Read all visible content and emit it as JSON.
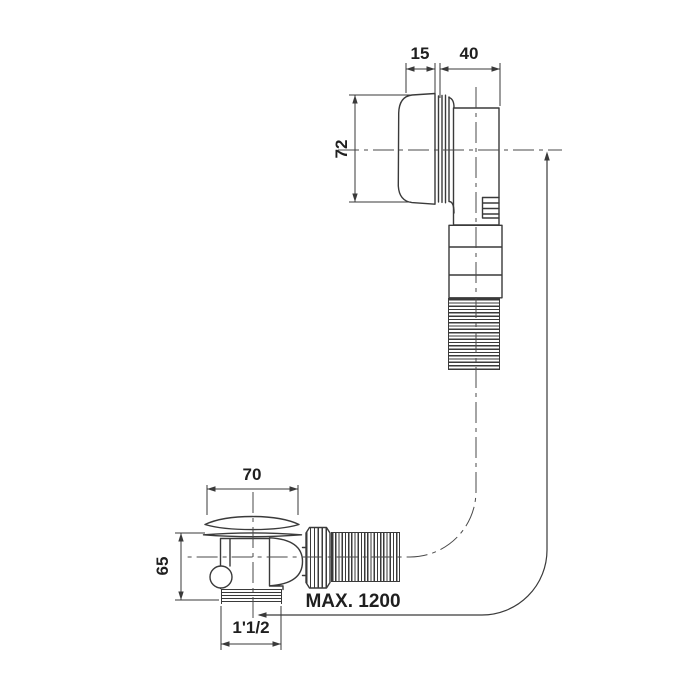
{
  "drawing": {
    "type": "technical-drawing",
    "subject": "bath waste and overflow fitting with flexible hose",
    "dimensions": {
      "overflow_cap_protrusion": "15",
      "overflow_body_depth": "40",
      "overflow_cap_diameter": "72",
      "drain_cap_diameter": "70",
      "drain_body_height": "65",
      "drain_thread_size": "1'1/2",
      "hose_max_length": "MAX. 1200"
    },
    "colors": {
      "line": "#3a3a3a",
      "centerline": "#4a4a4a",
      "text": "#1f1f1f",
      "background": "#ffffff"
    }
  }
}
